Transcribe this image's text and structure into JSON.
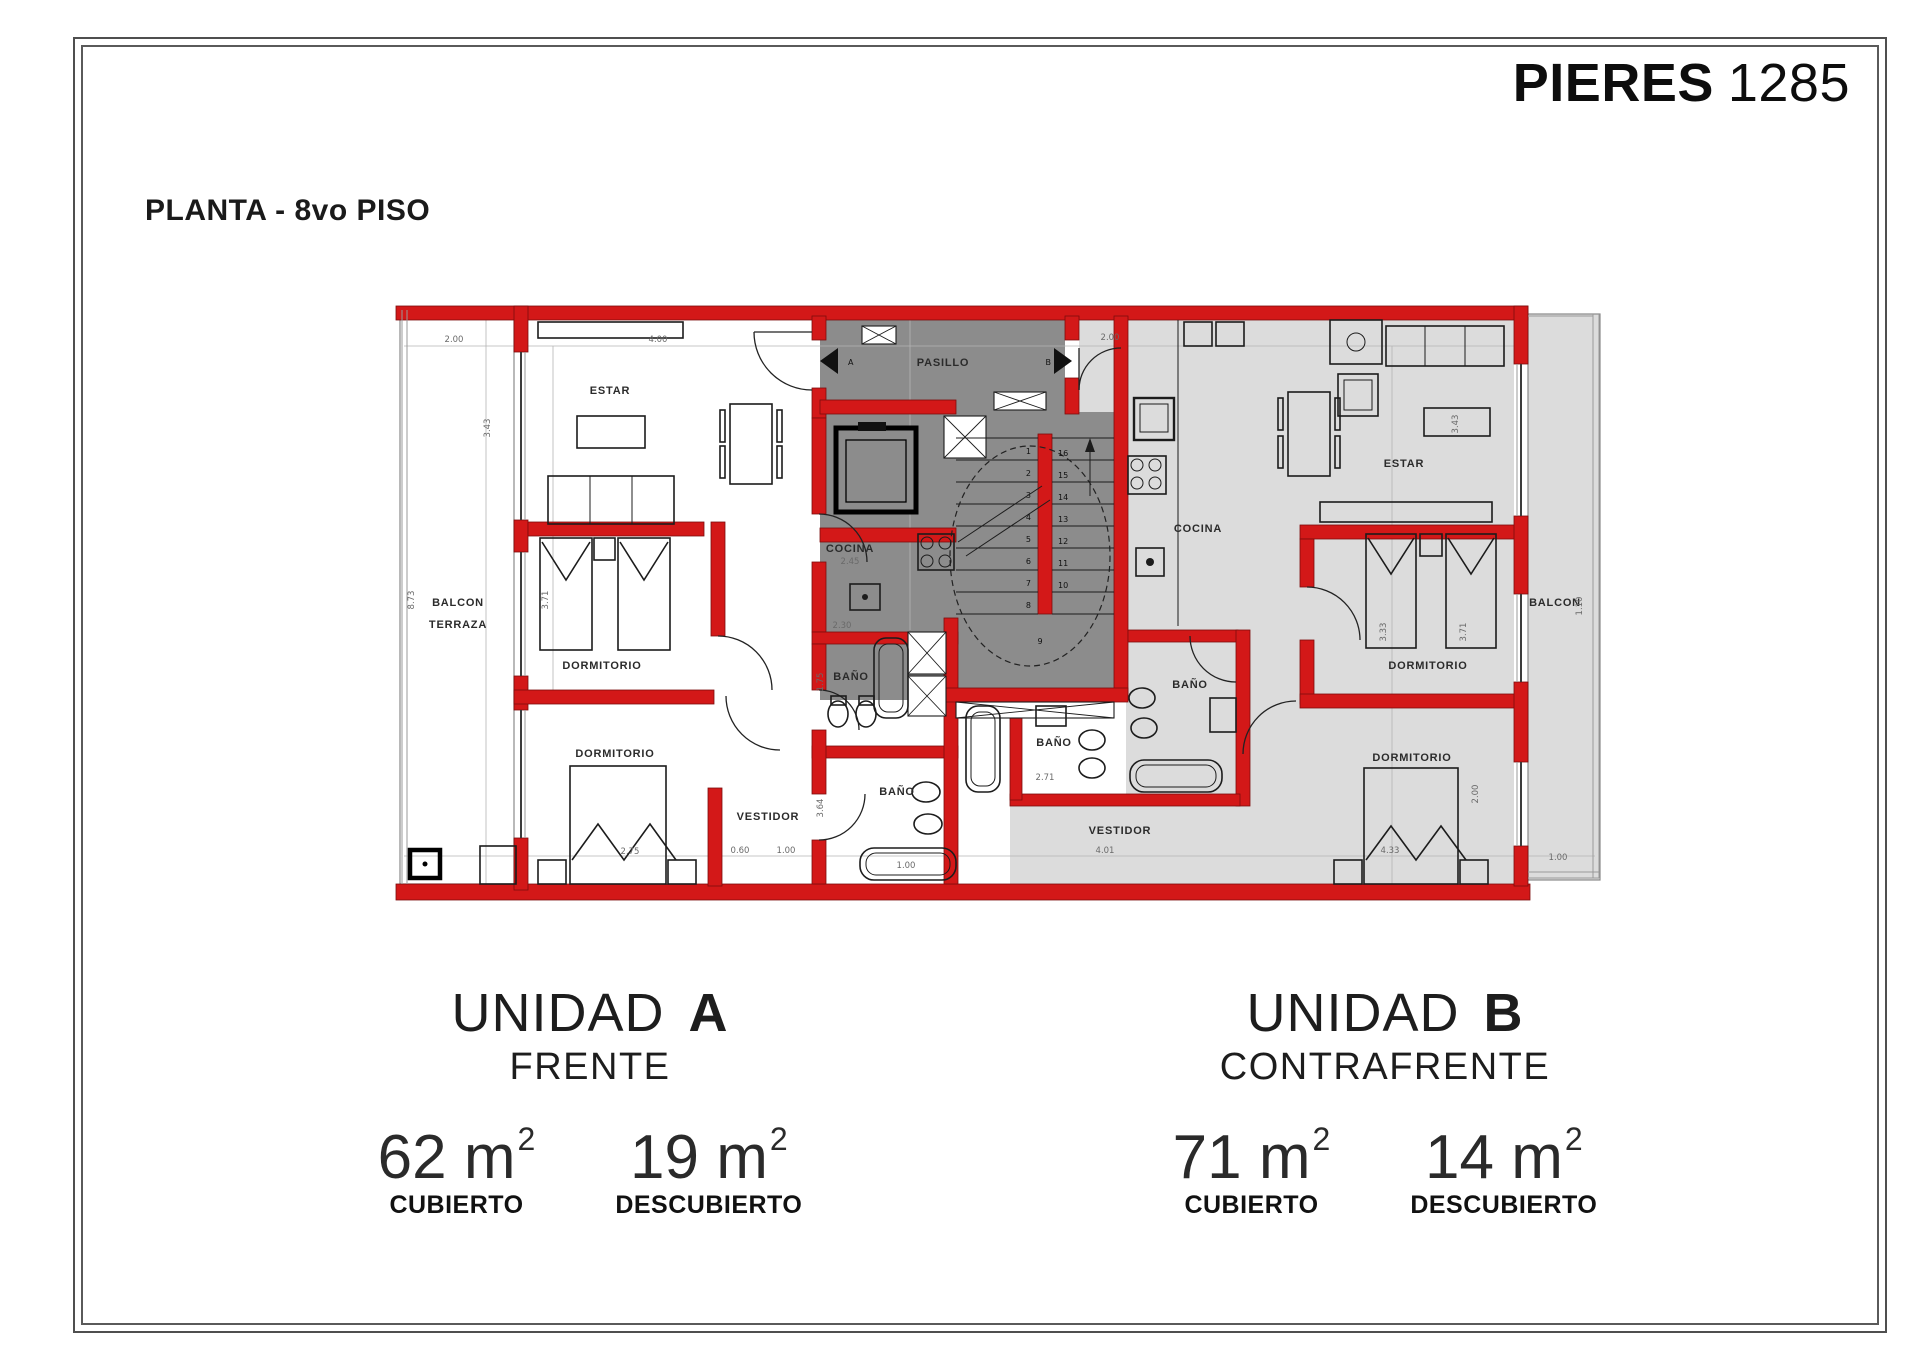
{
  "header": {
    "title_bold": "PIERES",
    "title_number": "1285"
  },
  "plan_title": "PLANTA - 8vo PISO",
  "floorplan": {
    "corridor": {
      "label": "PASILLO",
      "door_a": "A",
      "door_b": "B"
    },
    "rooms": {
      "estar_a": "ESTAR",
      "cocina_a": "COCINA",
      "bano_a1": "BAÑO",
      "bano_a2": "BAÑO",
      "dormitorio_a1": "DORMITORIO",
      "dormitorio_a2": "DORMITORIO",
      "vestidor_a": "VESTIDOR",
      "balcon_terraza_line1": "BALCON",
      "balcon_terraza_line2": "TERRAZA",
      "estar_b": "ESTAR",
      "cocina_b": "COCINA",
      "bano_b1": "BAÑO",
      "bano_b2": "BAÑO",
      "dormitorio_b1": "DORMITORIO",
      "dormitorio_b2": "DORMITORIO",
      "vestidor_b": "VESTIDOR",
      "balcon_b": "BALCON"
    },
    "stairs": {
      "left": [
        "1",
        "2",
        "3",
        "4",
        "5",
        "6",
        "7",
        "8"
      ],
      "right": [
        "16",
        "15",
        "14",
        "13",
        "12",
        "11",
        "10"
      ],
      "landing": "9"
    },
    "dimensions": {
      "d1": "2.00",
      "d2": "4.00",
      "d3": "3.43",
      "d4": "8.73",
      "d5": "2.45",
      "d6": "3.71",
      "d7": "2.30",
      "d8": "1.75",
      "d9": "3.64",
      "d10": "1.00",
      "d11": "2.75",
      "d12": "0.60",
      "d13": "1.00",
      "d14": "2.00",
      "d15": "2.71",
      "d16": "4.01",
      "d17": "3.33",
      "d18": "3.71",
      "d19": "4.33",
      "d20": "2.00",
      "d21": "1.10",
      "d22": "1.00",
      "d23": "3.43"
    }
  },
  "units": {
    "a": {
      "word": "UNIDAD",
      "letter": "A",
      "orientation": "FRENTE",
      "covered_value": "62 m",
      "covered_sup": "2",
      "covered_label": "CUBIERTO",
      "uncovered_value": "19 m",
      "uncovered_sup": "2",
      "uncovered_label": "DESCUBIERTO"
    },
    "b": {
      "word": "UNIDAD",
      "letter": "B",
      "orientation": "CONTRAFRENTE",
      "covered_value": "71 m",
      "covered_sup": "2",
      "covered_label": "CUBIERTO",
      "uncovered_value": "14 m",
      "uncovered_sup": "2",
      "uncovered_label": "DESCUBIERTO"
    }
  },
  "colors": {
    "wall_red": "#d31818",
    "wall_outline": "#7d0d0d",
    "core_gray": "#8c8c8c",
    "unit_b_floor": "#dcdcdc",
    "line_black": "#1c1c1c"
  }
}
